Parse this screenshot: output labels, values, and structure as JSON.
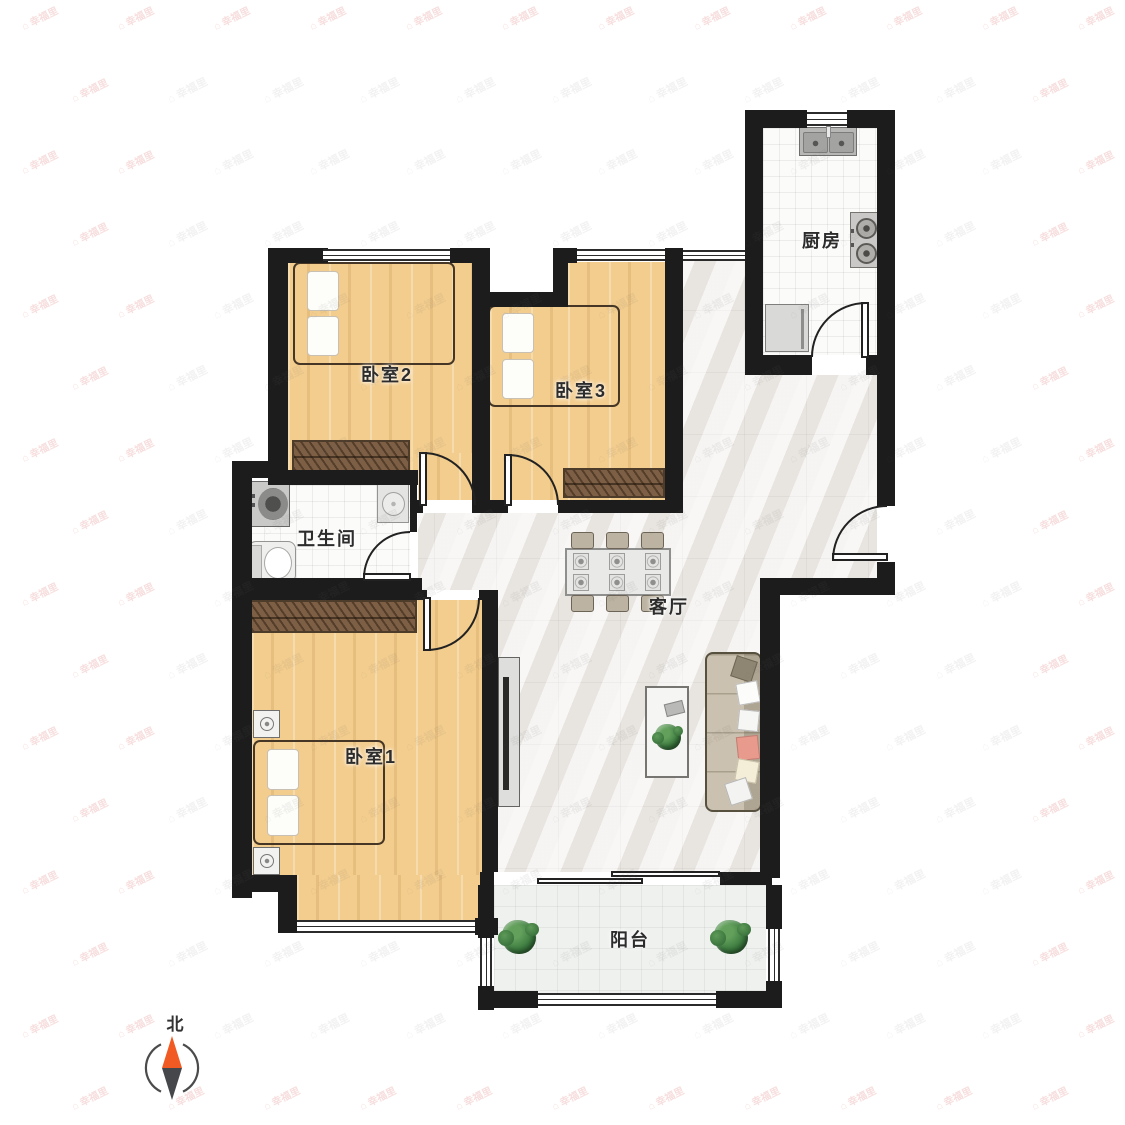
{
  "meta": {
    "type": "apartment-floor-plan",
    "units_shown": false
  },
  "rooms": {
    "kitchen": {
      "label": "厨房"
    },
    "bedroom2": {
      "label": "卧室2"
    },
    "bedroom3": {
      "label": "卧室3"
    },
    "bathroom": {
      "label": "卫生间"
    },
    "living": {
      "label": "客厅"
    },
    "bedroom1": {
      "label": "卧室1"
    },
    "balcony": {
      "label": "阳台"
    }
  },
  "compass": {
    "label": "北",
    "north_color": "#f15a22",
    "south_color": "#45474b"
  },
  "watermark": {
    "text": "幸福里",
    "house_glyph": "⌂"
  },
  "colors": {
    "wall": "#1c1c1c",
    "wood_floor": "#f3cd8e",
    "marble_floor": "#f1efec",
    "tile_floor": "#fbfbfa",
    "wardrobe": "#7d5f45",
    "bed_blanket": "#b79c81",
    "sofa": "#cbc1b0",
    "plant": "#3d7c40",
    "accent_north": "#f15a22"
  }
}
